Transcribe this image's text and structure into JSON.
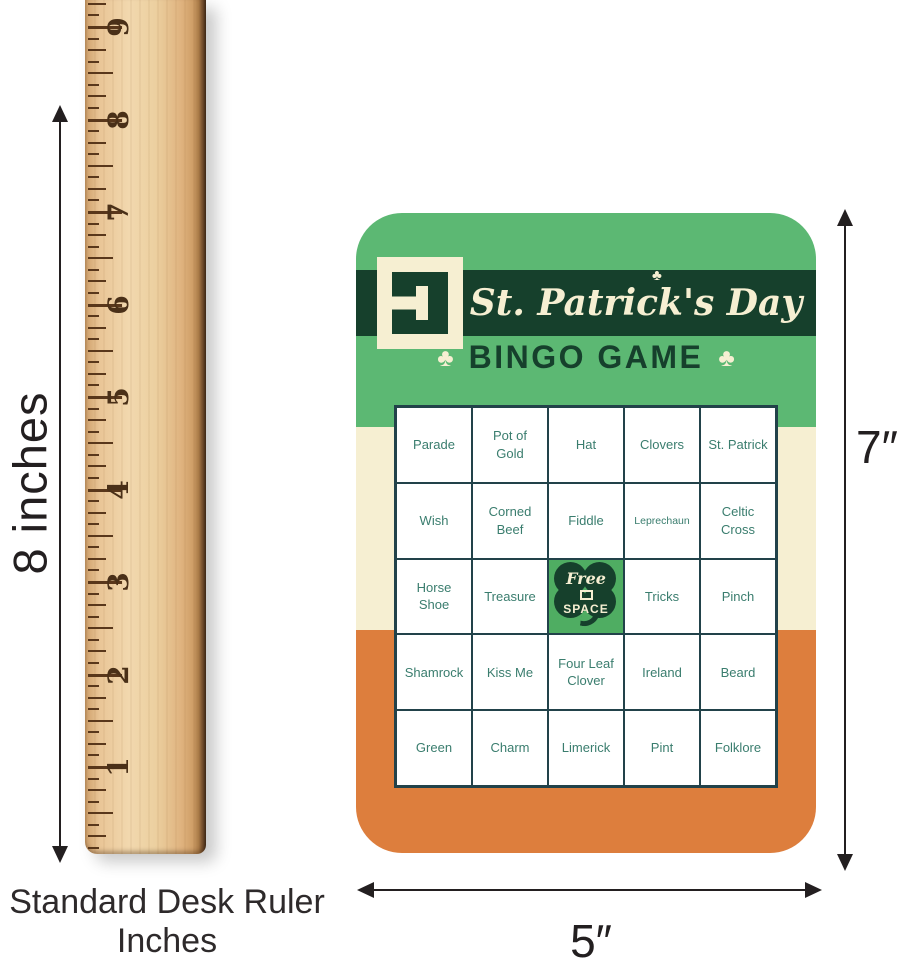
{
  "annotations": {
    "ruler_height_label": "8 inches",
    "card_height_label": "7″",
    "card_width_label": "5″",
    "caption_line1": "Standard Desk Ruler",
    "caption_line2": "Inches"
  },
  "ruler": {
    "inch_numbers": [
      "1",
      "2",
      "3",
      "4",
      "5",
      "6",
      "7",
      "8",
      "9"
    ]
  },
  "card": {
    "title": "St. Patrick's Day",
    "subtitle": "BINGO GAME",
    "shamrock_glyph": "♣",
    "free_space": {
      "line1": "Free",
      "line2": "SPACE"
    },
    "free_cell": {
      "row": 2,
      "col": 2
    },
    "small_text_cells": [
      "Leprechaun"
    ],
    "grid_rows": [
      [
        "Parade",
        "Pot of Gold",
        "Hat",
        "Clovers",
        "St. Patrick"
      ],
      [
        "Wish",
        "Corned Beef",
        "Fiddle",
        "Leprechaun",
        "Celtic Cross"
      ],
      [
        "Horse Shoe",
        "Treasure",
        "",
        "Tricks",
        "Pinch"
      ],
      [
        "Shamrock",
        "Kiss Me",
        "Four Leaf Clover",
        "Ireland",
        "Beard"
      ],
      [
        "Green",
        "Charm",
        "Limerick",
        "Pint",
        "Folklore"
      ]
    ],
    "colors": {
      "green": "#5cb873",
      "dark_green": "#16402c",
      "cream": "#f6efd2",
      "orange": "#dd7e3d",
      "free_green": "#4fad62",
      "cell_text": "#3a7d6e",
      "grid_line": "#22424a"
    }
  }
}
